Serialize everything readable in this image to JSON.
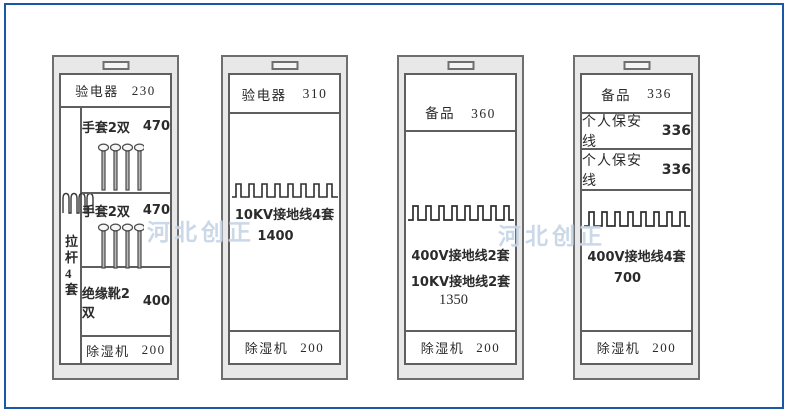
{
  "watermarks": [
    {
      "text": "河北创正"
    },
    {
      "text": "河北创正"
    }
  ],
  "colors": {
    "frame": "#1a57a5",
    "cabinet_fill": "#e8e8e8",
    "line": "#5f5f5f",
    "watermark": "#aac0da"
  },
  "icons": {
    "pull_rod": "coil-icon",
    "glove_rack": "pin-rack-icon",
    "ground_wire": "square-wave-icon"
  },
  "cabinets": {
    "c1": {
      "header": {
        "label": "验电器",
        "value": "230"
      },
      "pull_rod": {
        "line1": "拉杆",
        "line2": "4套"
      },
      "gloves1": {
        "label": "手套2双",
        "value": "470"
      },
      "gloves2": {
        "label": "手套2双",
        "value": "470"
      },
      "boots": {
        "label": "绝缘靴2双",
        "value": "400"
      },
      "dehumidifier": {
        "label": "除湿机",
        "value": "200"
      }
    },
    "c2": {
      "header": {
        "label": "验电器",
        "value": "310"
      },
      "ground": {
        "label": "10KV接地线4套",
        "value": "1400"
      },
      "dehumidifier": {
        "label": "除湿机",
        "value": "200"
      }
    },
    "c3": {
      "header": {
        "label": "备品",
        "value": "360"
      },
      "ground": {
        "line1": "400V接地线2套",
        "line2": "10KV接地线2套",
        "value": "1350"
      },
      "dehumidifier": {
        "label": "除湿机",
        "value": "200"
      }
    },
    "c4": {
      "header": {
        "label": "备品",
        "value": "336"
      },
      "safety1": {
        "label": "个人保安线",
        "value": "336"
      },
      "safety2": {
        "label": "个人保安线",
        "value": "336"
      },
      "ground": {
        "label": "400V接地线4套",
        "value": "700"
      },
      "dehumidifier": {
        "label": "除湿机",
        "value": "200"
      }
    }
  }
}
